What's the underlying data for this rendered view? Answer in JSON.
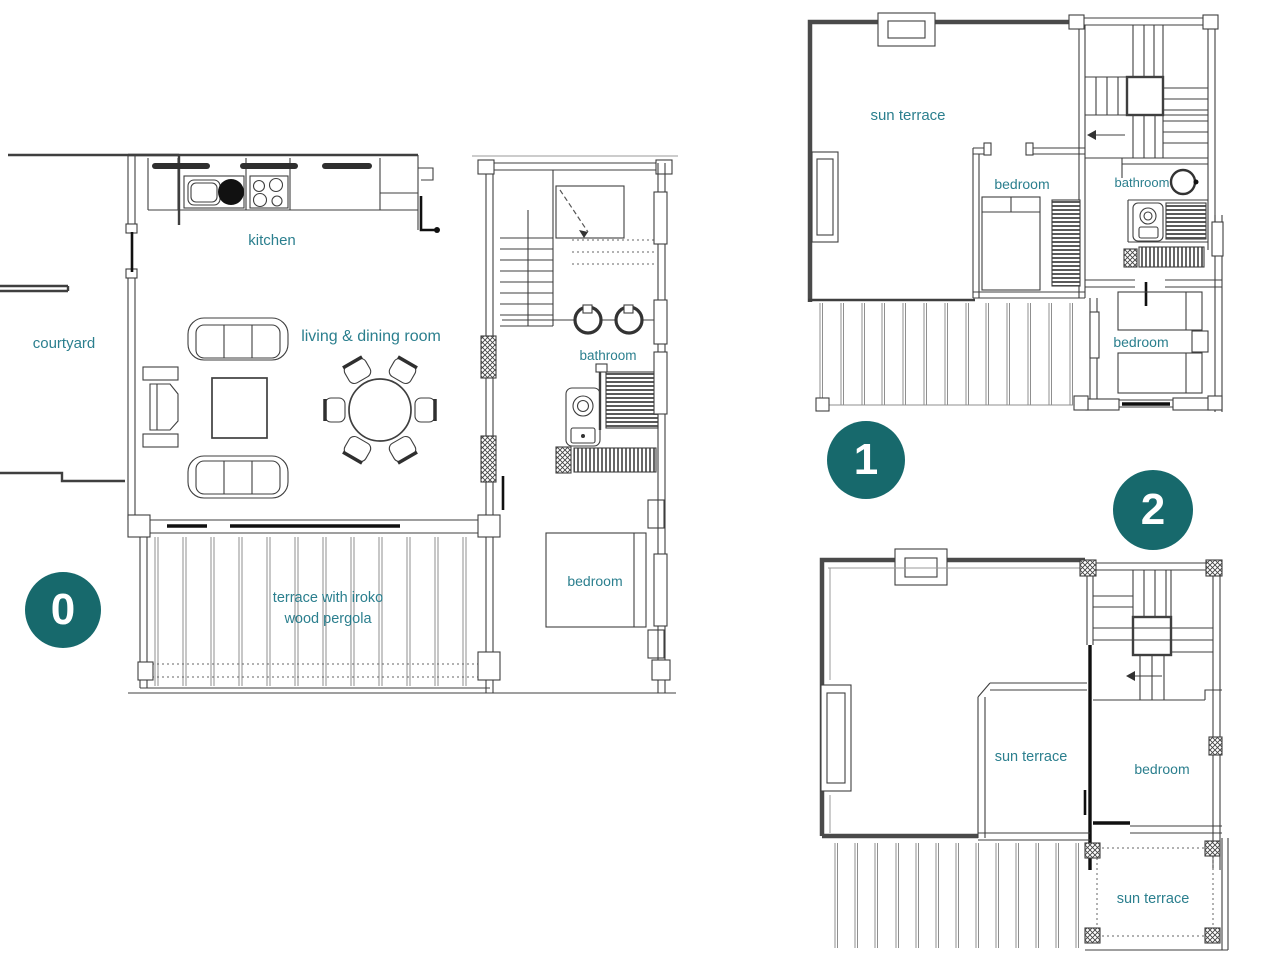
{
  "colors": {
    "label_color": "#2b7f8e",
    "badge_color": "#17696c",
    "badge_text_color": "#ffffff",
    "line_color": "#3f3f3f"
  },
  "floors": [
    {
      "badge": "0",
      "labels": {
        "kitchen": "kitchen",
        "courtyard": "courtyard",
        "living_dining": "living & dining room",
        "bathroom": "bathroom",
        "bedroom": "bedroom",
        "terrace1": "terrace with iroko",
        "terrace2": "wood pergola"
      }
    },
    {
      "badge": "1",
      "labels": {
        "sun_terrace": "sun terrace",
        "bedroom_center": "bedroom",
        "bathroom": "bathroom",
        "bedroom_right": "bedroom"
      }
    },
    {
      "badge": "2",
      "labels": {
        "sun_terrace": "sun terrace",
        "bedroom": "bedroom",
        "sun_terrace_lower": "sun terrace"
      }
    }
  ]
}
